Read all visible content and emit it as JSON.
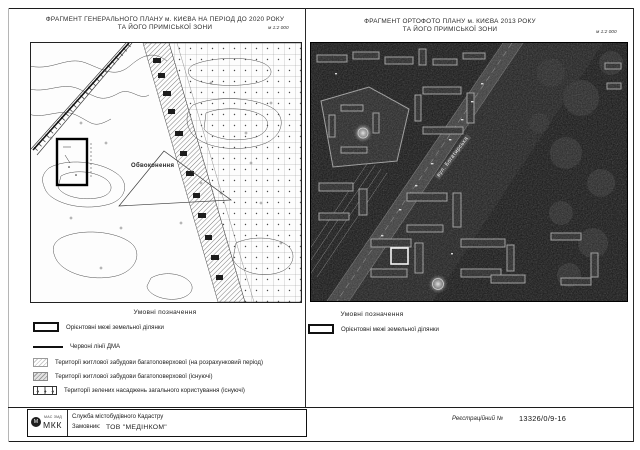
{
  "sheet": {
    "left_panel": {
      "title_line1": "ФРАГМЕНТ ГЕНЕРАЛЬНОГО ПЛАНУ м. КИЄВА НА ПЕРІОД ДО 2020 РОКУ",
      "title_line2": "ТА ЙОГО ПРИМІСЬКОЇ ЗОНИ",
      "scale": "м 1:2 000",
      "map_label": "Обвоконення",
      "legend_title": "Умовні позначення",
      "legend_items": [
        {
          "symbol": "parcel-boundary",
          "label": "Орієнтовні межі земельної ділянки"
        },
        {
          "symbol": "red-line-dma",
          "label": "Червоні лінії ДМА"
        },
        {
          "symbol": "hatch-planned",
          "label": "Території житлової забудови багатоповерхової (на розрахунковий період)"
        },
        {
          "symbol": "hatch-existing",
          "label": "Території житлової забудови багатоповерхової (існуючі)"
        },
        {
          "symbol": "dots-green",
          "label": "Території зелених насаджень загального користування (існуючі)"
        }
      ]
    },
    "right_panel": {
      "title_line1": "ФРАГМЕНТ ОРТОФОТО ПЛАНУ м. КИЄВА 2013 РОКУ",
      "title_line2": "ТА ЙОГО ПРИМІСЬКОЇ ЗОНИ",
      "scale": "м 1:2 000",
      "street_label": "вул. Богатирська",
      "legend_title": "Умовні позначення",
      "legend_items": [
        {
          "symbol": "parcel-boundary",
          "label": "Орієнтовні межі земельної ділянки"
        }
      ]
    },
    "footer": {
      "logo_caption": "МАС ЗМД",
      "logo_text": "МКК",
      "org_line": "Служба містобудівного Кадастру",
      "client_label": "Замовник:",
      "client_value": "ТОВ \"МЕДІНКОМ\"",
      "reg_label": "Реєстраційний №",
      "reg_value": "13326/0/9-16"
    }
  }
}
